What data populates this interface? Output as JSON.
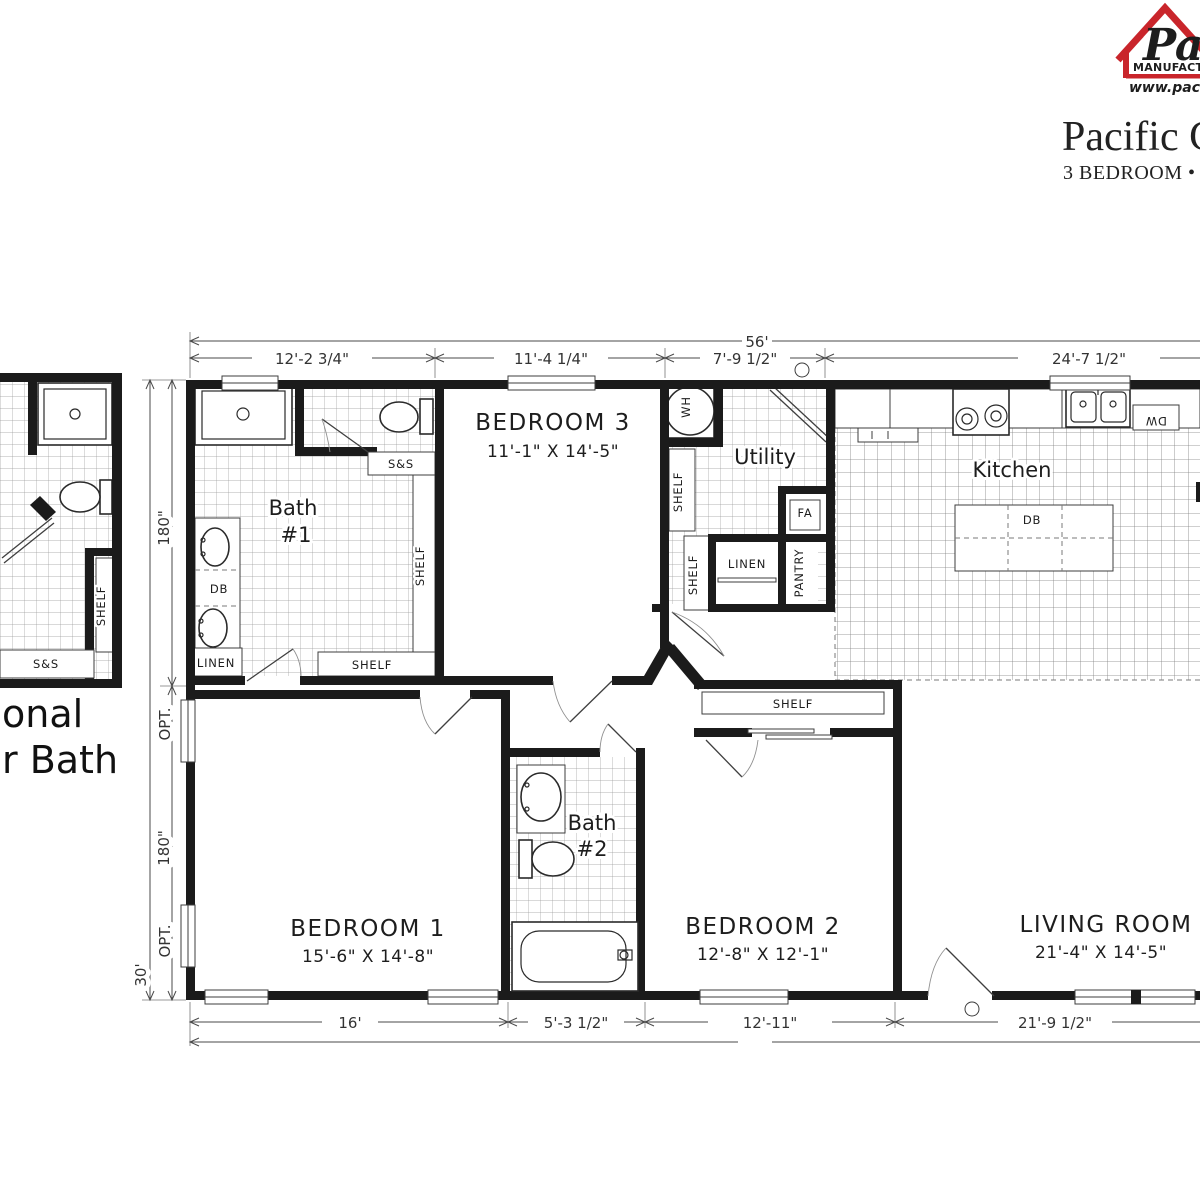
{
  "header": {
    "logo": {
      "script_text": "Pa",
      "line1": "MANUFACTU",
      "line2": "www.pacifi",
      "house_color": "#c9252b",
      "blue": "#233d8f"
    },
    "title": "Pacific Ch",
    "subtitle": "3 BEDROOM • 2 B"
  },
  "dims": {
    "overall_width": "56'",
    "overall_height": "30'",
    "top": [
      "12'-2 3/4\"",
      "11'-4 1/4\"",
      "7'-9 1/2\"",
      "24'-7 1/2\""
    ],
    "bottom": [
      "16'",
      "5'-3 1/2\"",
      "12'-11\"",
      "21'-9 1/2\""
    ],
    "left_upper": "180\"",
    "left_lower": "180\"",
    "opt_upper": "OPT.",
    "opt_lower": "OPT."
  },
  "rooms": {
    "bedroom3": {
      "name": "BEDROOM 3",
      "size": "11'-1\" X 14'-5\""
    },
    "bedroom1": {
      "name": "BEDROOM 1",
      "size": "15'-6\" X 14'-8\""
    },
    "bedroom2": {
      "name": "BEDROOM 2",
      "size": "12'-8\" X 12'-1\""
    },
    "living": {
      "name": "LIVING ROOM",
      "size": "21'-4\" X 14'-5\""
    },
    "utility": "Utility",
    "kitchen": "Kitchen",
    "bath1_line1": "Bath",
    "bath1_line2": "#1",
    "bath2_line1": "Bath",
    "bath2_line2": "#2"
  },
  "fixtures": {
    "wh": "WH",
    "fa": "FA",
    "dw": "DW",
    "db": "DB",
    "linen": "LINEN",
    "pantry": "PANTRY",
    "shelf": "SHELF",
    "ss": "S&S"
  },
  "optional_plan": {
    "caption_line1": "onal",
    "caption_line2": "r Bath"
  }
}
